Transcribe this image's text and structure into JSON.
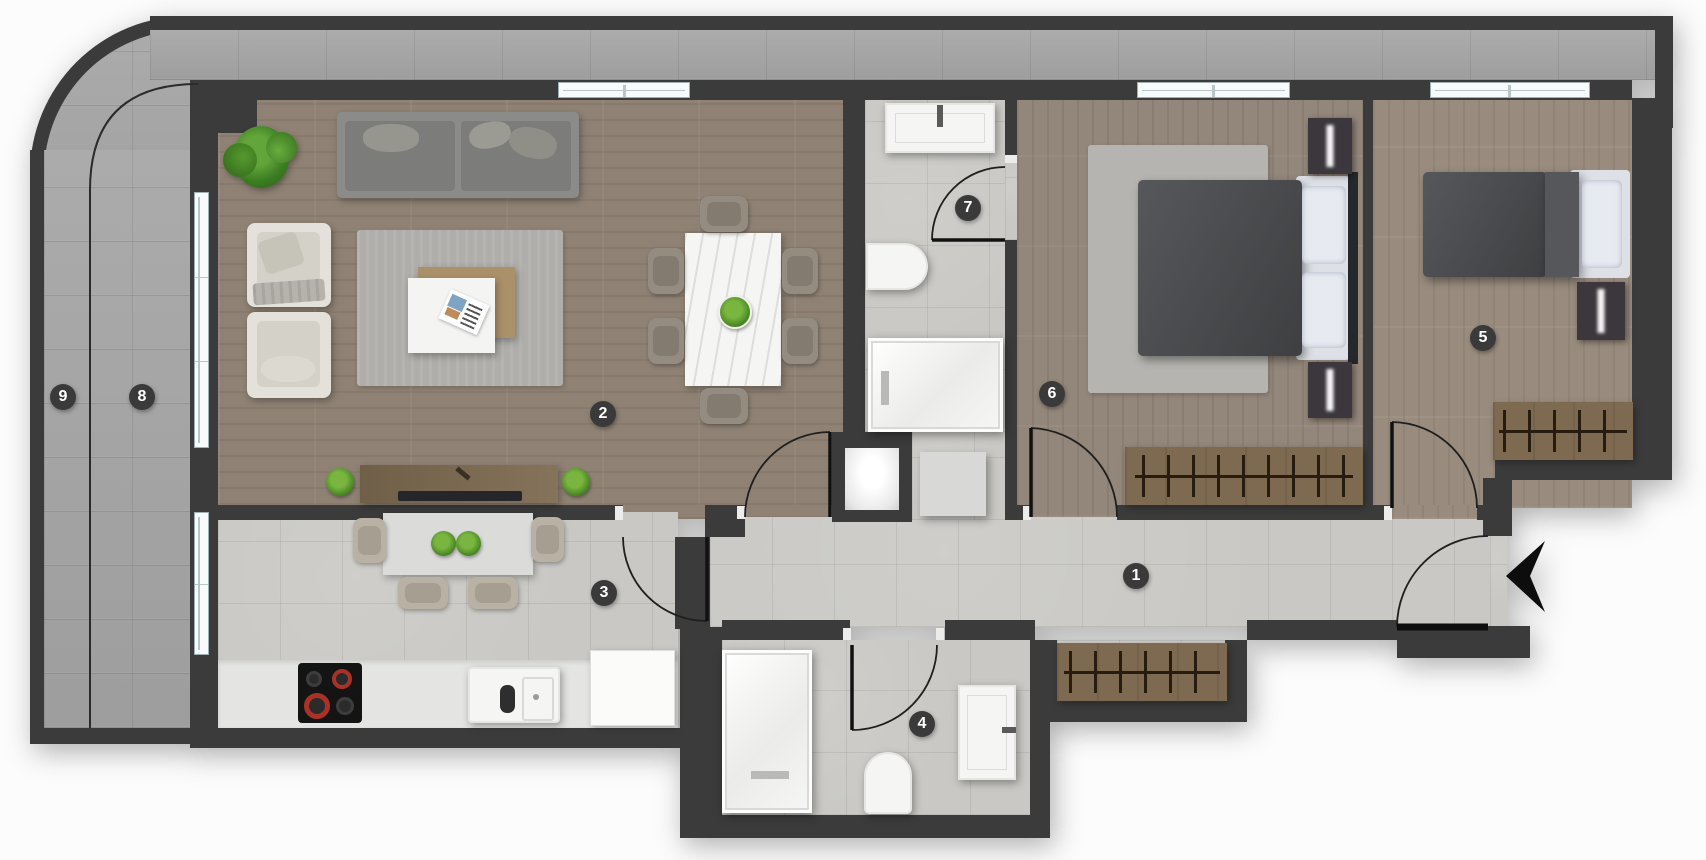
{
  "floorplan": {
    "type": "apartment-floor-plan",
    "rooms": [
      {
        "number": "1",
        "key": "hallway",
        "label_x": 1136,
        "label_y": 576
      },
      {
        "number": "2",
        "key": "living-room",
        "label_x": 603,
        "label_y": 414
      },
      {
        "number": "3",
        "key": "kitchen",
        "label_x": 604,
        "label_y": 593
      },
      {
        "number": "4",
        "key": "bathroom-lower",
        "label_x": 922,
        "label_y": 724
      },
      {
        "number": "5",
        "key": "bedroom-right",
        "label_x": 1483,
        "label_y": 338
      },
      {
        "number": "6",
        "key": "bedroom-middle",
        "label_x": 1052,
        "label_y": 394
      },
      {
        "number": "7",
        "key": "bathroom-upper",
        "label_x": 968,
        "label_y": 208
      },
      {
        "number": "8",
        "key": "balcony-inner",
        "label_x": 142,
        "label_y": 397
      },
      {
        "number": "9",
        "key": "balcony-outer",
        "label_x": 63,
        "label_y": 397
      }
    ],
    "entrance_arrow": {
      "direction": "left",
      "x": 1525,
      "y": 576
    },
    "colors": {
      "wall": "#3b3b3b",
      "tile": "#c9c8c4",
      "stone": "#a6a6a6",
      "wood_living": "#8f8274",
      "wood_bedroom": "#998c7e",
      "wood_furniture": "#7d6a50",
      "bed_duvet": "#4b4d50",
      "label_bg": "#3a3a3a",
      "label_text": "#ffffff",
      "burner_red": "#a93226"
    }
  }
}
